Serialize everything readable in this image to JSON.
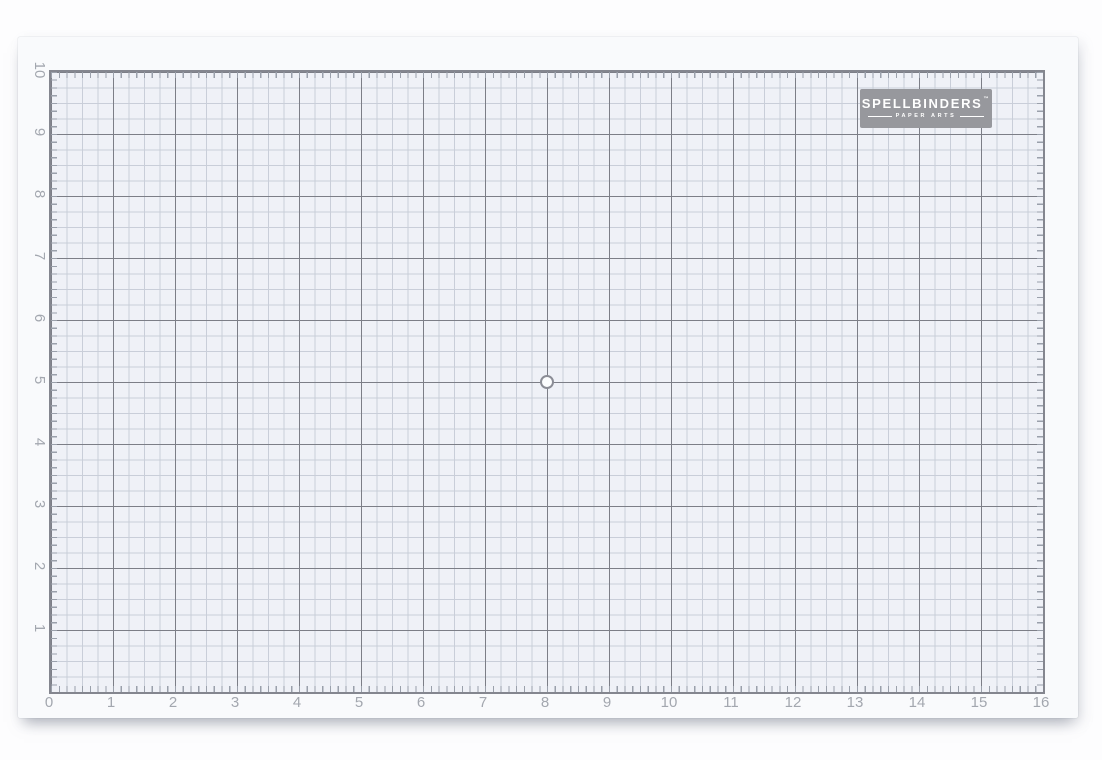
{
  "brand": {
    "name": "SPELLBINDERS",
    "trademark": "™",
    "subtitle": "PAPER ARTS"
  },
  "grid": {
    "x_labels": [
      "0",
      "1",
      "2",
      "3",
      "4",
      "5",
      "6",
      "7",
      "8",
      "9",
      "10",
      "11",
      "12",
      "13",
      "14",
      "15",
      "16"
    ],
    "y_labels": [
      "10",
      "9",
      "8",
      "7",
      "6",
      "5",
      "4",
      "3",
      "2",
      "1"
    ],
    "width_inches": 16,
    "height_inches": 10,
    "subdivision": "quarter-inch grid, eighth-inch edge ticks",
    "center_mark_position": "8,5"
  },
  "colors": {
    "page_background": "#fdfdfe",
    "mat_surface": "#f9fafc",
    "grid_fill": "#eff1f7",
    "minor_line": "#c9ced9",
    "major_line": "#7c7e87",
    "border_line": "#84868f",
    "tick": "#9aa0ab",
    "label_text": "#a3a7af",
    "logo_background": "#97989d",
    "logo_text": "#ffffff"
  }
}
